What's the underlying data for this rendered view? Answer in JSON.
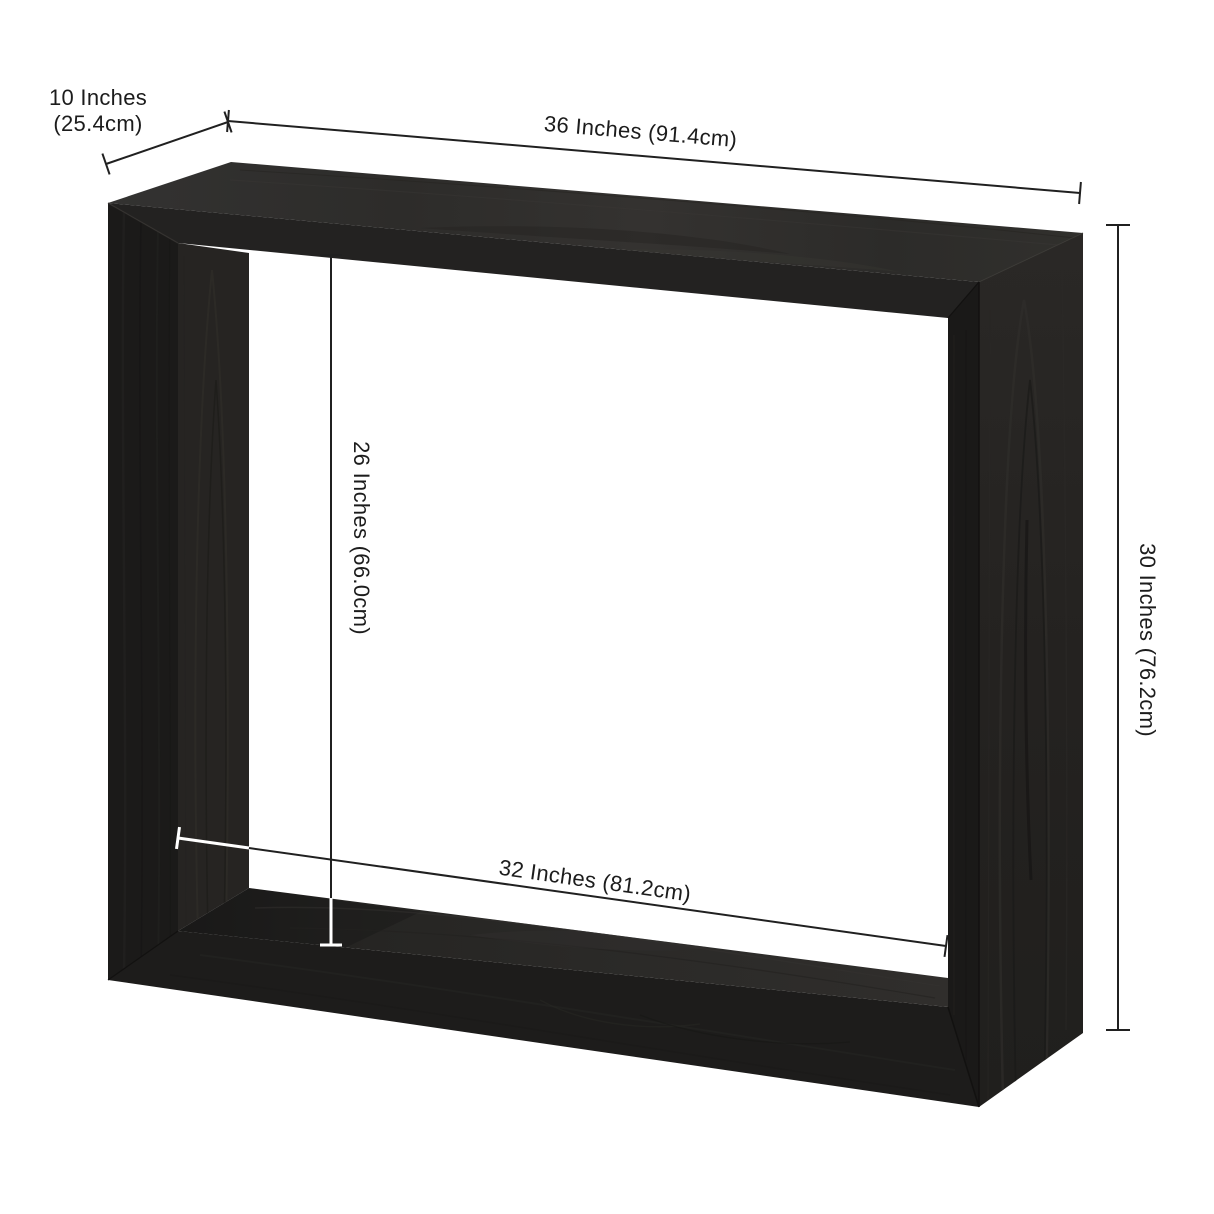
{
  "diagram": {
    "title": "Open-frame console table dimension diagram",
    "product": "Black woodgrain rectangular open-frame console table"
  },
  "dimensions": {
    "depth": {
      "line1": "10 Inches",
      "line2": "(25.4cm)"
    },
    "width": {
      "label": "36 Inches (91.4cm)"
    },
    "height": {
      "label": "30 Inches (76.2cm)"
    },
    "opening_height": {
      "label": "26 Inches (66.0cm)"
    },
    "opening_width": {
      "label": "32 Inches (81.2cm)"
    }
  },
  "colors": {
    "background": "#ffffff",
    "dimension_line": "#202020",
    "dimension_line_on_wood": "#ffffff",
    "label_text": "#1c1c1c",
    "wood_top_face": "#31302e",
    "wood_front_face": "#1d1c1b",
    "wood_right_side": "#252321",
    "wood_inner_left": "#262422",
    "wood_bottom_shelf": "#2b2a28"
  }
}
